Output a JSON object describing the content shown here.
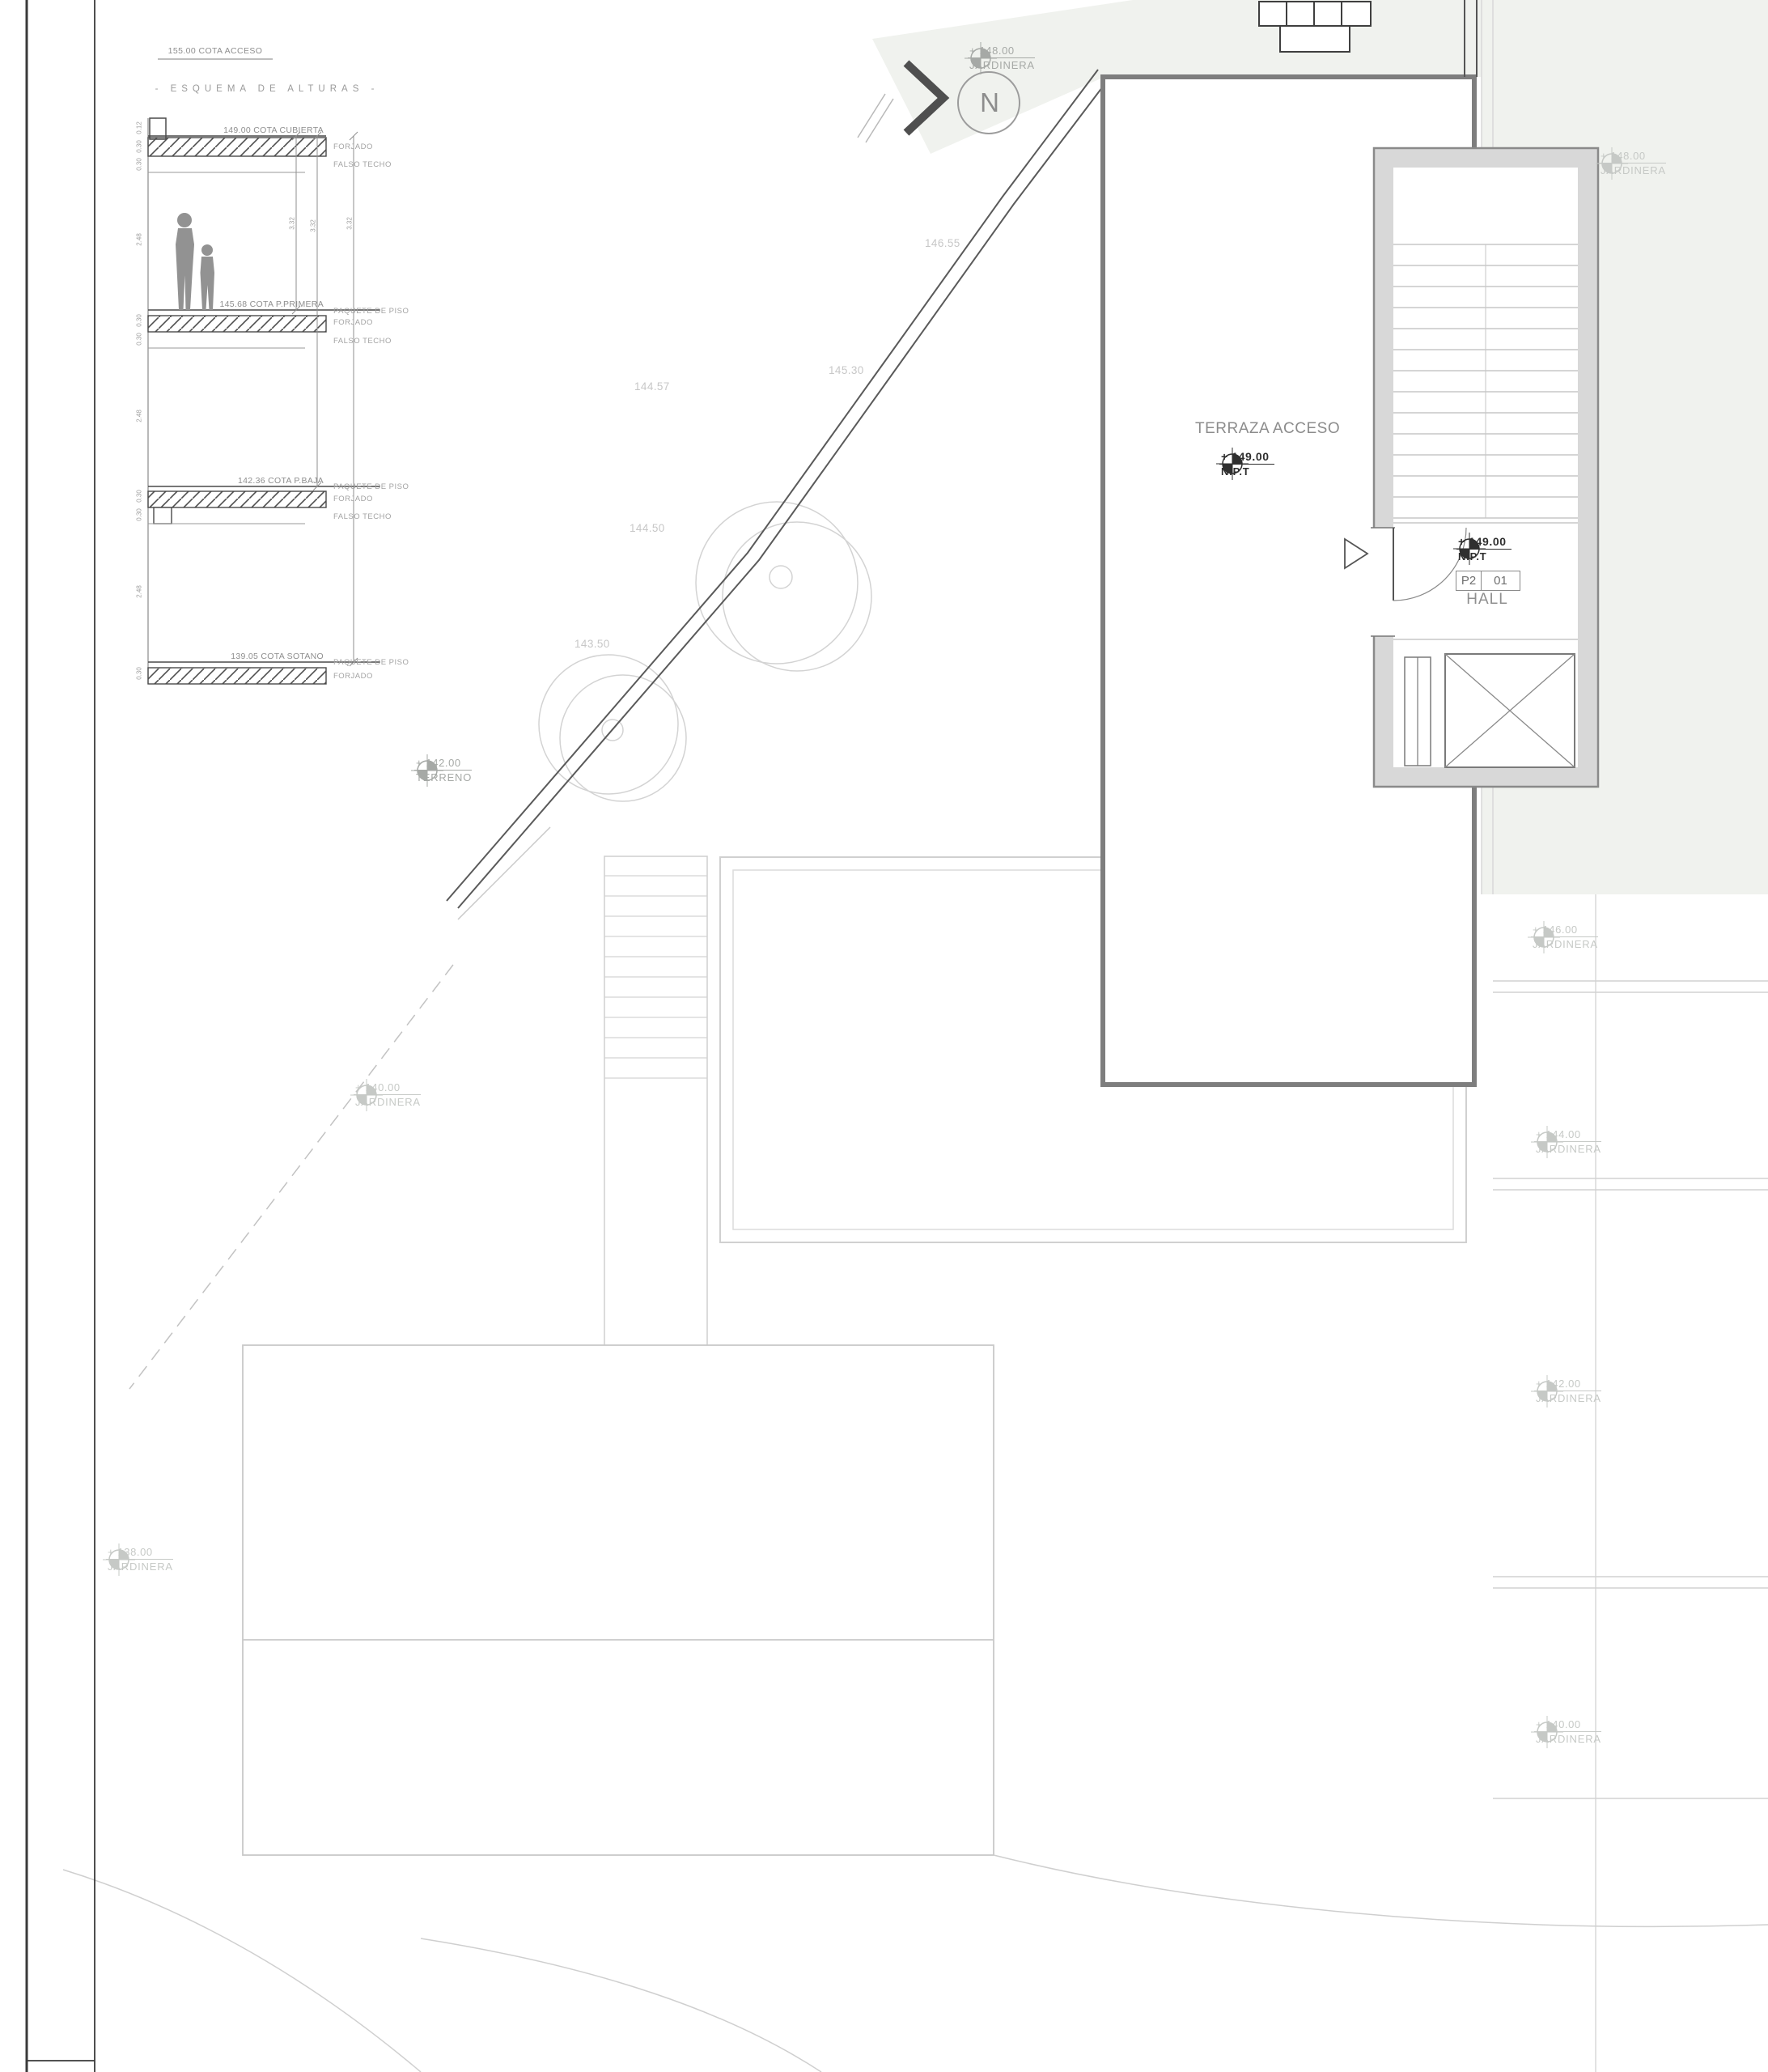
{
  "sheet": {
    "cota_acceso": "155.00 COTA ACCESO",
    "schema_title": "- ESQUEMA DE ALTURAS -"
  },
  "schema": {
    "floors": [
      {
        "cota": "149.00 COTA CUBIERTA",
        "paquete": "",
        "forjado": "FORJADO",
        "falso": "FALSO TECHO"
      },
      {
        "cota": "145.68 COTA P.PRIMERA",
        "paquete": "PAQUETE DE PISO",
        "forjado": "FORJADO",
        "falso": "FALSO TECHO"
      },
      {
        "cota": "142.36 COTA P.BAJA",
        "paquete": "PAQUETE DE PISO",
        "forjado": "FORJADO",
        "falso": "FALSO TECHO"
      },
      {
        "cota": "139.05 COTA SOTANO",
        "paquete": "PAQUETE DE PISO",
        "forjado": "FORJADO",
        "falso": ""
      }
    ],
    "dims": {
      "s012": "0.12",
      "s030": "0.30",
      "h248": "2.48",
      "d332": "3.32"
    }
  },
  "north": {
    "label": "N"
  },
  "plan": {
    "terraza_label": "TERRAZA ACCESO",
    "hall": {
      "name": "HALL",
      "tag_plant": "P2",
      "tag_num": "01"
    }
  },
  "markers": [
    {
      "value": "+ 148.00",
      "label": "JARDINERA"
    },
    {
      "value": "+ 148.00",
      "label": "JARDINERA"
    },
    {
      "value": "+ 149.00",
      "label": "N.P.T"
    },
    {
      "value": "+ 149.00",
      "label": "N.P.T"
    },
    {
      "value": "+ 142.00",
      "label": "TERRENO"
    },
    {
      "value": "+ 140.00",
      "label": "JARDINERA"
    },
    {
      "value": "+ 146.00",
      "label": "JARDINERA"
    },
    {
      "value": "+ 144.00",
      "label": "JARDINERA"
    },
    {
      "value": "+ 142.00",
      "label": "JARDINERA"
    },
    {
      "value": "+ 140.00",
      "label": "JARDINERA"
    },
    {
      "value": "+ 138.00",
      "label": "JARDINERA"
    }
  ],
  "contours": [
    "146.55",
    "145.30",
    "144.57",
    "144.50",
    "143.50"
  ],
  "colors": {
    "tint": "#f0f2ee",
    "wall_gray": "#d8d8d8",
    "dark_line": "#4a4a4a",
    "light_line": "#cfcfcf"
  }
}
